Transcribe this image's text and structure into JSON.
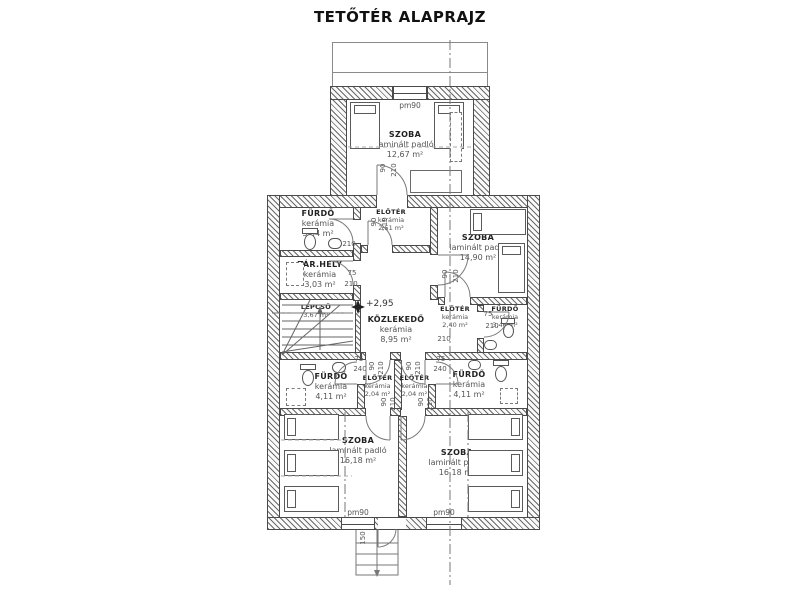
{
  "title": "TETŐTÉR ALAPRAJZ",
  "level_mark": "+2,95",
  "rooms": {
    "szoba_top": {
      "name": "SZOBA",
      "material": "laminált padló",
      "area": "12,67 m²"
    },
    "furdo_tl": {
      "name": "FÜRDŐ",
      "material": "kerámia",
      "area": "3,54 m²"
    },
    "eloter_top": {
      "name": "ELŐTÉR",
      "material": "kerámia",
      "area": "2,51 m²"
    },
    "szoba_right": {
      "name": "SZOBA",
      "material": "laminált padló",
      "area": "14,90 m²"
    },
    "tarhely": {
      "name": "TÁR.HELY",
      "material": "kerámia",
      "area": "3,03 m²"
    },
    "lepcso": {
      "name": "LEPCSŐ",
      "area": "3,67 m²"
    },
    "kozlekedo": {
      "name": "KÖZLEKEDŐ",
      "material": "kerámia",
      "area": "8,95 m²"
    },
    "eloter_right": {
      "name": "ELŐTÉR",
      "material": "kerámia",
      "area": "2,40 m²"
    },
    "furdo_tr": {
      "name": "FÜRDŐ",
      "material": "kerámia",
      "area": "3,46 m²"
    },
    "furdo_bl": {
      "name": "FÜRDŐ",
      "material": "kerámia",
      "area": "4,11 m²"
    },
    "eloter_bl": {
      "name": "ELŐTÉR",
      "material": "kerámia",
      "area": "2,04 m²"
    },
    "eloter_br": {
      "name": "ELŐTÉR",
      "material": "kerámia",
      "area": "2,04 m²"
    },
    "furdo_br": {
      "name": "FÜRDŐ",
      "material": "kerámia",
      "area": "4,11 m²"
    },
    "szoba_bl": {
      "name": "SZOBA",
      "material": "laminált padló",
      "area": "16,18 m²"
    },
    "szoba_br": {
      "name": "SZOBA",
      "material": "laminált padló",
      "area": "16,18 m²"
    }
  },
  "dims": {
    "d90": "90",
    "d210": "210",
    "d75": "75",
    "d240": "240",
    "d150": "150",
    "pm90": "pm90"
  },
  "line_color": "#4a4a4a"
}
